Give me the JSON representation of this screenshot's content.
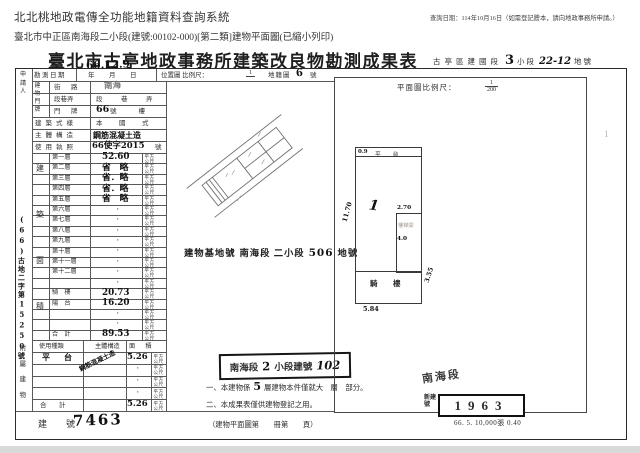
{
  "colors": {
    "paper": "#ffffff",
    "ink": "#2e2e2e",
    "grid_line": "#585858",
    "window_edge": "#d9d9d9"
  },
  "page_header": {
    "system_title": "北北桃地政電傳全功能地籍資料查詢系統",
    "query_date_note": "查詢日期：114年10月16日（如需登記謄本，請向地政事務所申請。）",
    "document_line": "臺北市中正區南海段二小段(建號:00102-000)[第二類]建物平面圖(已縮小列印)"
  },
  "form": {
    "title": "臺北市古亭地政事務所建築改良物勘測成果表",
    "locality": {
      "prefix": "古亭區建國段",
      "subsection_no": "3",
      "subsection_label": "小段",
      "parcel_no": "22-12",
      "parcel_label": "地號"
    },
    "survey_row": {
      "label": "勘測日期",
      "date_handwritten": "66.12.9",
      "date_template": "年　月　日",
      "location_scale_label": "位置圖 比例尺：",
      "location_scale_numerator": "1",
      "location_scale_denominator": "",
      "cadastral_label": "地籍圖",
      "cadastral_no": "6",
      "cadastral_unit": "號"
    },
    "plan_scale": {
      "label": "平面圖比例尺：",
      "numerator": "1",
      "denominator": "200"
    },
    "margin": {
      "applicant_label": "申請人",
      "file_no": "(66)古地二字第15250號"
    },
    "address": {
      "group_label": "建物門牌",
      "rows": [
        {
          "label": "街　路",
          "value": "南海"
        },
        {
          "label": "段巷弄",
          "value": "段　巷　弄"
        },
        {
          "label": "門　牌",
          "value": "66",
          "suffix": "號　　樓"
        }
      ]
    },
    "info_rows": [
      {
        "label": "建築式樣",
        "value": "本　國　式"
      },
      {
        "label": "主體構造",
        "value": "鋼筋混凝土造"
      },
      {
        "label": "使用執照",
        "value": "66使字2015",
        "suffix": "號"
      }
    ],
    "building_area": {
      "group_label": "建築面積",
      "unit": "平方公尺",
      "rows": [
        {
          "label": "第一層",
          "value": "52.60",
          "hw": true
        },
        {
          "label": "第二層",
          "value": "省　略",
          "hw": true
        },
        {
          "label": "第三層",
          "value": "省．略",
          "hw": true
        },
        {
          "label": "第四層",
          "value": "省．略",
          "hw": true
        },
        {
          "label": "第五層",
          "value": "省　略",
          "hw": true
        },
        {
          "label": "第六層",
          "value": "・"
        },
        {
          "label": "第七層",
          "value": "・"
        },
        {
          "label": "第八層",
          "value": "・"
        },
        {
          "label": "第九層",
          "value": "・"
        },
        {
          "label": "第十層",
          "value": "・"
        },
        {
          "label": "第十一層",
          "value": "・"
        },
        {
          "label": "第十二層",
          "value": "・"
        },
        {
          "label": "",
          "value": "・"
        },
        {
          "label": "騎　樓",
          "value": "20.73",
          "hw": true
        },
        {
          "label": "陽　台",
          "value": "16.20",
          "hw": true
        },
        {
          "label": "",
          "value": "・"
        },
        {
          "label": "",
          "value": "・"
        },
        {
          "label": "合　計",
          "value": "89.53",
          "hw": true
        }
      ]
    },
    "attached": {
      "group_label": "附屬建物",
      "headers": [
        "使用種類",
        "主體構造",
        "面　積"
      ],
      "unit": "平方公尺",
      "rows": [
        {
          "type": "平　台",
          "structure": "鋼筋混凝土造",
          "area": "5.26"
        },
        {
          "type": "",
          "structure": "",
          "area": "・"
        },
        {
          "type": "",
          "structure": "",
          "area": "・"
        },
        {
          "type": "",
          "structure": "",
          "area": "・"
        },
        {
          "type": "合　計",
          "structure": "",
          "area": "5.26"
        }
      ]
    },
    "base_parcel": {
      "label": "建物基地號",
      "section": "南海段 二小段",
      "parcel_no": "506",
      "suffix": "地號"
    },
    "stamp_box": {
      "section": "南海段",
      "subsection_no": "2",
      "label": "小段建號",
      "building_no": "102"
    },
    "notes": [
      {
        "text_before": "一、本建物係",
        "hw": "5",
        "text_after": "層建物本件僅就大　層　部分。"
      },
      {
        "text_before": "二、本成果表僅供建物登記之用。",
        "hw": "",
        "text_after": ""
      }
    ],
    "bottom": {
      "label": "建　號",
      "value": "7463",
      "plan_book": "（建物平面圖第　　冊第　　頁）"
    },
    "right_stamps": {
      "handwritten_section": "南海段",
      "new_no_label": "新建號",
      "new_no_value": "1963",
      "print_code": "66. 5. 10,000張 0.40"
    },
    "plan": {
      "stray_mark": "1",
      "annotations": {
        "top_left": "0.9",
        "top_label": "平　台",
        "left": "11.70",
        "floor_no": "1",
        "inner_width": "2.70",
        "inner_label": "樓梯間",
        "inner_height": "4.0",
        "arcade": "騎　樓",
        "right": "3.55",
        "bottom": "5.84"
      }
    }
  }
}
